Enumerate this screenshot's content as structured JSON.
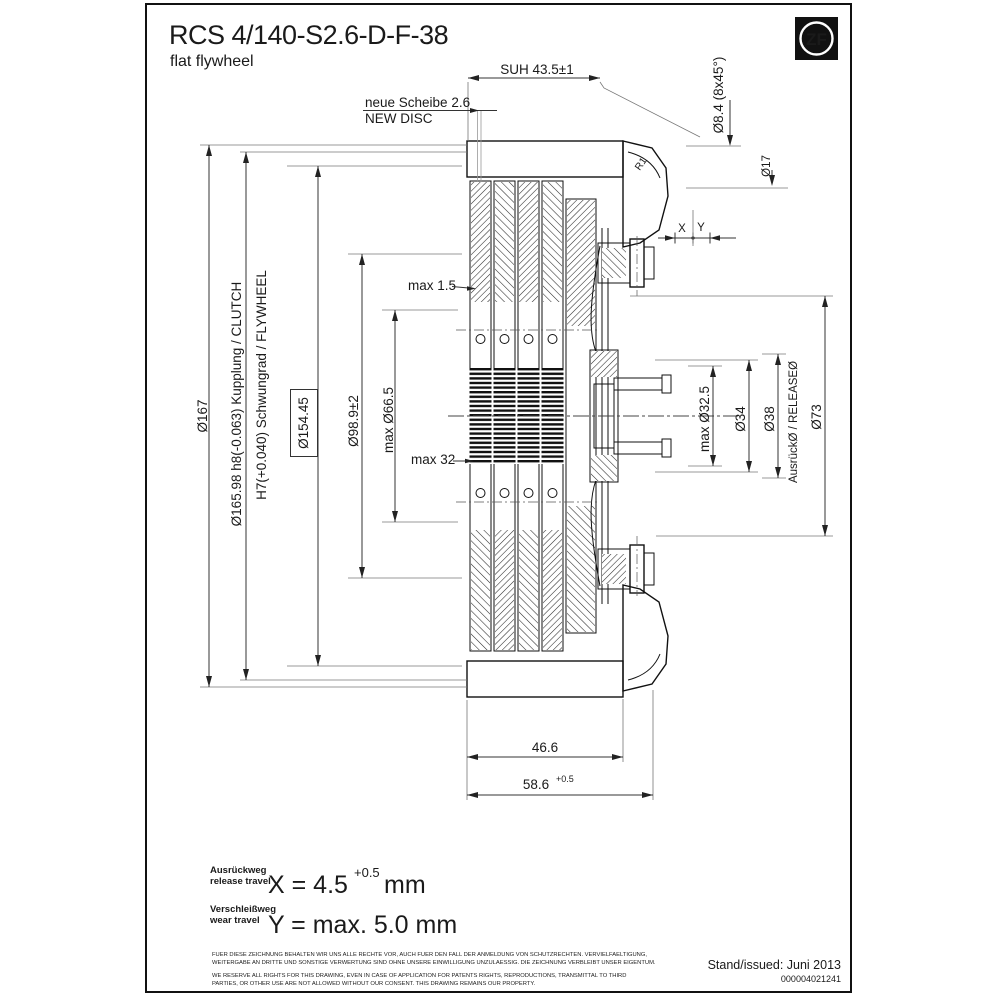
{
  "title": {
    "model": "RCS 4/140-S2.6-D-F-38",
    "subtitle": "flat flywheel"
  },
  "logo": {
    "text": "ZF"
  },
  "dims": {
    "suh": "SUH 43.5±1",
    "new_disc_de": "neue Scheibe 2.6",
    "new_disc_en": "NEW DISC",
    "bolt_holes": "Ø8.4 (8x45°)",
    "d17": "Ø17",
    "r1": "R1",
    "x_label": "X",
    "y_label": "Y",
    "d167": "Ø167",
    "clutch_fit": "Ø165.98 h8(-0.063) Kupplung / CLUTCH",
    "flywheel_fit": "H7(+0.040) Schwungrad / FLYWHEEL",
    "d154": "Ø154.45",
    "d98": "Ø98.9±2",
    "d66": "max Ø66.5",
    "max15": "max 1.5",
    "max32": "max 32",
    "d32_5": "max Ø32.5",
    "d34": "Ø34",
    "d38": "Ø38",
    "release_label": "AusrückØ / RELEASEØ",
    "d73": "Ø73",
    "w466": "46.6",
    "w586": "58.6",
    "w586_tol": "+0.5"
  },
  "travel": {
    "release_de": "Ausrückweg",
    "release_en": "release travel",
    "release_value": "X = 4.5",
    "release_tol": "+0.5",
    "release_unit": "mm",
    "wear_de": "Verschleißweg",
    "wear_en": "wear travel",
    "wear_value": "Y = max. 5.0 mm"
  },
  "legal": {
    "line1": "FUER DIESE ZEICHNUNG BEHALTEN WIR UNS ALLE RECHTE VOR, AUCH FUER DEN FALL DER ANMELDUNG VON SCHUTZRECHTEN. VERVIELFAELTIGUNG,",
    "line2": "WEITERGABE AN DRITTE UND SONSTIGE VERWERTUNG SIND OHNE UNSERE EINWILLIGUNG UNZULAESSIG. DIE ZEICHNUNG VERBLEIBT UNSER EIGENTUM.",
    "line3": "WE RESERVE ALL RIGHTS FOR THIS DRAWING, EVEN IN CASE OF APPLICATION FOR PATENTS RIGHTS, REPRODUCTIONS, TRANSMITTAL TO THIRD",
    "line4": "PARTIES, OR OTHER USE ARE NOT ALLOWED WITHOUT OUR CONSENT. THIS DRAWING REMAINS OUR PROPERTY."
  },
  "issued": {
    "label": "Stand/issued: Juni 2013",
    "doc_number": "000004021241"
  }
}
